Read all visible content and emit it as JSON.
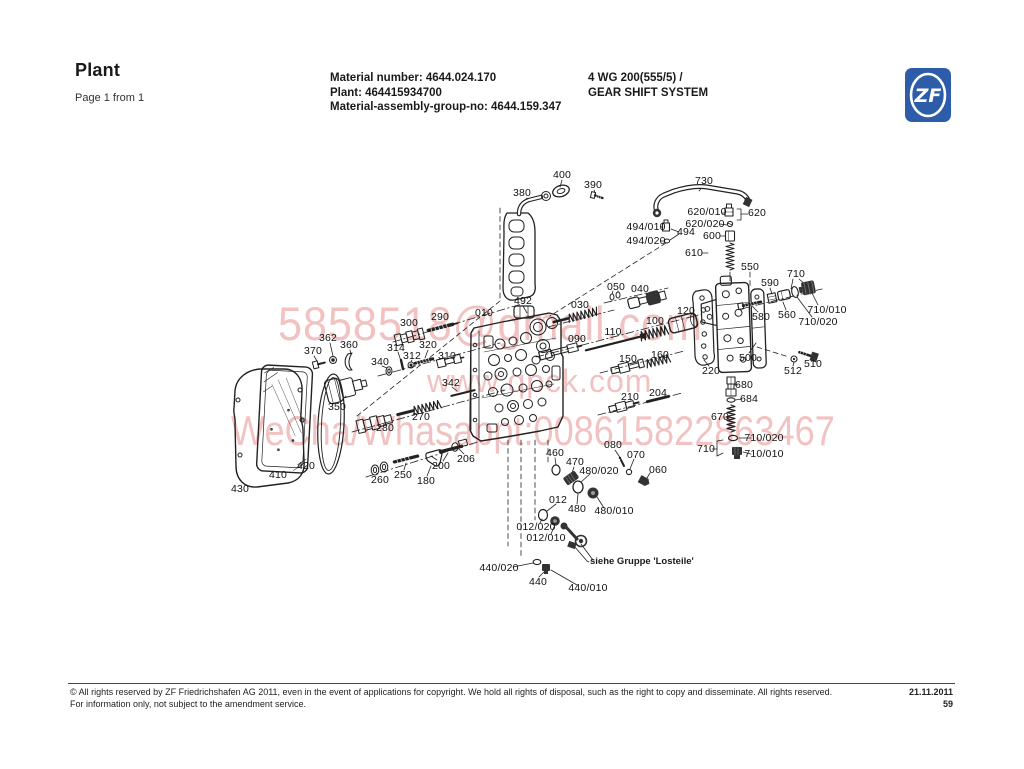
{
  "header": {
    "title": "Plant",
    "page_info": "Page 1 from 1",
    "material_number": "Material number: 4644.024.170",
    "plant_no": "Plant: 464415934700",
    "assembly_group": "Material-assembly-group-no: 4644.159.347",
    "model": "4 WG 200(555/5) /",
    "system": "GEAR SHIFT SYSTEM",
    "logo_text": "ZF"
  },
  "watermark": {
    "lines": [
      "5858518@gmail.com",
      "www.qpck.com",
      "WeCha/Whasappt:008615822863467"
    ],
    "color": "rgba(228,128,128,0.48)"
  },
  "diagram": {
    "note": "siehe Gruppe 'Losteile'",
    "callouts": [
      {
        "text": "400",
        "x": 562,
        "y": 175
      },
      {
        "text": "390",
        "x": 593,
        "y": 185
      },
      {
        "text": "380",
        "x": 522,
        "y": 193
      },
      {
        "text": "730",
        "x": 704,
        "y": 181
      },
      {
        "text": "620/010",
        "x": 707,
        "y": 212
      },
      {
        "text": "620/020",
        "x": 705,
        "y": 224
      },
      {
        "text": "620",
        "x": 757,
        "y": 213
      },
      {
        "text": "494/010",
        "x": 646,
        "y": 227
      },
      {
        "text": "494/020",
        "x": 646,
        "y": 241
      },
      {
        "text": "494",
        "x": 686,
        "y": 232
      },
      {
        "text": "600",
        "x": 712,
        "y": 236
      },
      {
        "text": "610",
        "x": 694,
        "y": 253
      },
      {
        "text": "550",
        "x": 750,
        "y": 267
      },
      {
        "text": "590",
        "x": 770,
        "y": 283
      },
      {
        "text": "710",
        "x": 796,
        "y": 274
      },
      {
        "text": "580",
        "x": 761,
        "y": 317
      },
      {
        "text": "560",
        "x": 787,
        "y": 315
      },
      {
        "text": "710/010",
        "x": 827,
        "y": 310
      },
      {
        "text": "710/020",
        "x": 818,
        "y": 322
      },
      {
        "text": "510",
        "x": 813,
        "y": 364
      },
      {
        "text": "512",
        "x": 793,
        "y": 371
      },
      {
        "text": "500",
        "x": 748,
        "y": 358
      },
      {
        "text": "220",
        "x": 711,
        "y": 371
      },
      {
        "text": "680",
        "x": 744,
        "y": 385
      },
      {
        "text": "684",
        "x": 749,
        "y": 399
      },
      {
        "text": "670",
        "x": 720,
        "y": 417
      },
      {
        "text": "710/020",
        "x": 764,
        "y": 438
      },
      {
        "text": "710",
        "x": 706,
        "y": 449
      },
      {
        "text": "710/010",
        "x": 764,
        "y": 454
      },
      {
        "text": "492",
        "x": 523,
        "y": 301
      },
      {
        "text": "030",
        "x": 580,
        "y": 305
      },
      {
        "text": "050",
        "x": 616,
        "y": 287
      },
      {
        "text": "040",
        "x": 640,
        "y": 289
      },
      {
        "text": "010",
        "x": 484,
        "y": 313
      },
      {
        "text": "090",
        "x": 577,
        "y": 339
      },
      {
        "text": "110",
        "x": 613,
        "y": 332
      },
      {
        "text": "100",
        "x": 655,
        "y": 321
      },
      {
        "text": "120",
        "x": 686,
        "y": 311
      },
      {
        "text": "150",
        "x": 628,
        "y": 359
      },
      {
        "text": "160",
        "x": 660,
        "y": 355
      },
      {
        "text": "210",
        "x": 630,
        "y": 397
      },
      {
        "text": "204",
        "x": 658,
        "y": 393
      },
      {
        "text": "300",
        "x": 409,
        "y": 323
      },
      {
        "text": "290",
        "x": 440,
        "y": 317
      },
      {
        "text": "370",
        "x": 313,
        "y": 351
      },
      {
        "text": "362",
        "x": 328,
        "y": 338
      },
      {
        "text": "360",
        "x": 349,
        "y": 345
      },
      {
        "text": "340",
        "x": 380,
        "y": 362
      },
      {
        "text": "314",
        "x": 396,
        "y": 348
      },
      {
        "text": "312",
        "x": 412,
        "y": 356
      },
      {
        "text": "320",
        "x": 428,
        "y": 345
      },
      {
        "text": "310",
        "x": 447,
        "y": 356
      },
      {
        "text": "342",
        "x": 451,
        "y": 383
      },
      {
        "text": "350",
        "x": 337,
        "y": 407
      },
      {
        "text": "270",
        "x": 421,
        "y": 417
      },
      {
        "text": "280",
        "x": 385,
        "y": 428
      },
      {
        "text": "430",
        "x": 240,
        "y": 489
      },
      {
        "text": "410",
        "x": 278,
        "y": 475
      },
      {
        "text": "420",
        "x": 306,
        "y": 466
      },
      {
        "text": "260",
        "x": 380,
        "y": 480
      },
      {
        "text": "250",
        "x": 403,
        "y": 475
      },
      {
        "text": "180",
        "x": 426,
        "y": 481
      },
      {
        "text": "200",
        "x": 441,
        "y": 466
      },
      {
        "text": "206",
        "x": 466,
        "y": 459
      },
      {
        "text": "460",
        "x": 555,
        "y": 453
      },
      {
        "text": "470",
        "x": 575,
        "y": 462
      },
      {
        "text": "480/020",
        "x": 599,
        "y": 471
      },
      {
        "text": "080",
        "x": 613,
        "y": 445
      },
      {
        "text": "070",
        "x": 636,
        "y": 455
      },
      {
        "text": "060",
        "x": 658,
        "y": 470
      },
      {
        "text": "012",
        "x": 558,
        "y": 500
      },
      {
        "text": "480",
        "x": 577,
        "y": 509
      },
      {
        "text": "480/010",
        "x": 614,
        "y": 511
      },
      {
        "text": "012/020",
        "x": 536,
        "y": 527
      },
      {
        "text": "012/010",
        "x": 546,
        "y": 538
      },
      {
        "text": "440/020",
        "x": 499,
        "y": 568
      },
      {
        "text": "440",
        "x": 538,
        "y": 582
      },
      {
        "text": "440/010",
        "x": 588,
        "y": 588
      }
    ]
  },
  "footer": {
    "line1": "© All rights reserved by ZF Friedrichshafen AG 2011, even in the event of applications for copyright. We hold all rights of disposal, such as the right to copy and disseminate. All rights reserved.",
    "date": "21.11.2011",
    "line2": "For information only, not subject to the amendment service.",
    "page_number": "59"
  },
  "colors": {
    "logo_blue": "#2d5ca8",
    "line_art": "#222222",
    "watermark_pink": "#e48080"
  }
}
